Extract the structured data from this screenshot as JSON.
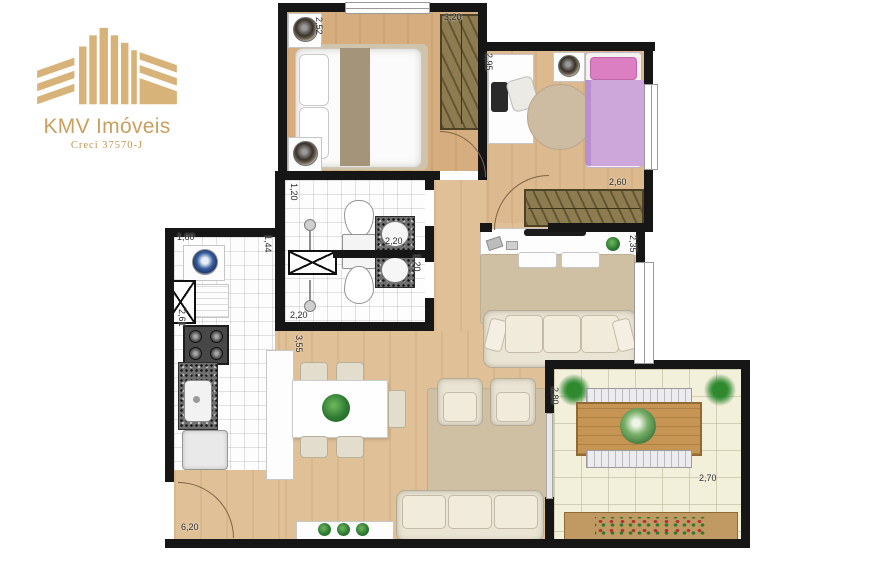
{
  "logo": {
    "title": "KMV Imóveis",
    "subtitle": "Creci 37570-J",
    "accent_color": "#c9a05e"
  },
  "floorplan": {
    "dims": {
      "d252": "2,52",
      "d320": "3,20",
      "d295": "2,95",
      "d260": "2,60",
      "d235": "2,35",
      "d120a": "1,20",
      "d220a": "2,20",
      "d144": "1,44",
      "d120b": "1,20",
      "d220b": "2,20",
      "d160": "1,60",
      "d261": "2,61",
      "d355": "3,55",
      "d280": "2,80",
      "d270": "2,70",
      "d620": "6,20"
    },
    "colors": {
      "wall": "#161616",
      "wood_floor": "#ddbb90",
      "balcony_floor": "#f2efda",
      "wardrobe": "#8d7c50",
      "bed_pink": "#cda6da",
      "rug": "#cfc0a3",
      "gold": "#c9a05e"
    }
  }
}
